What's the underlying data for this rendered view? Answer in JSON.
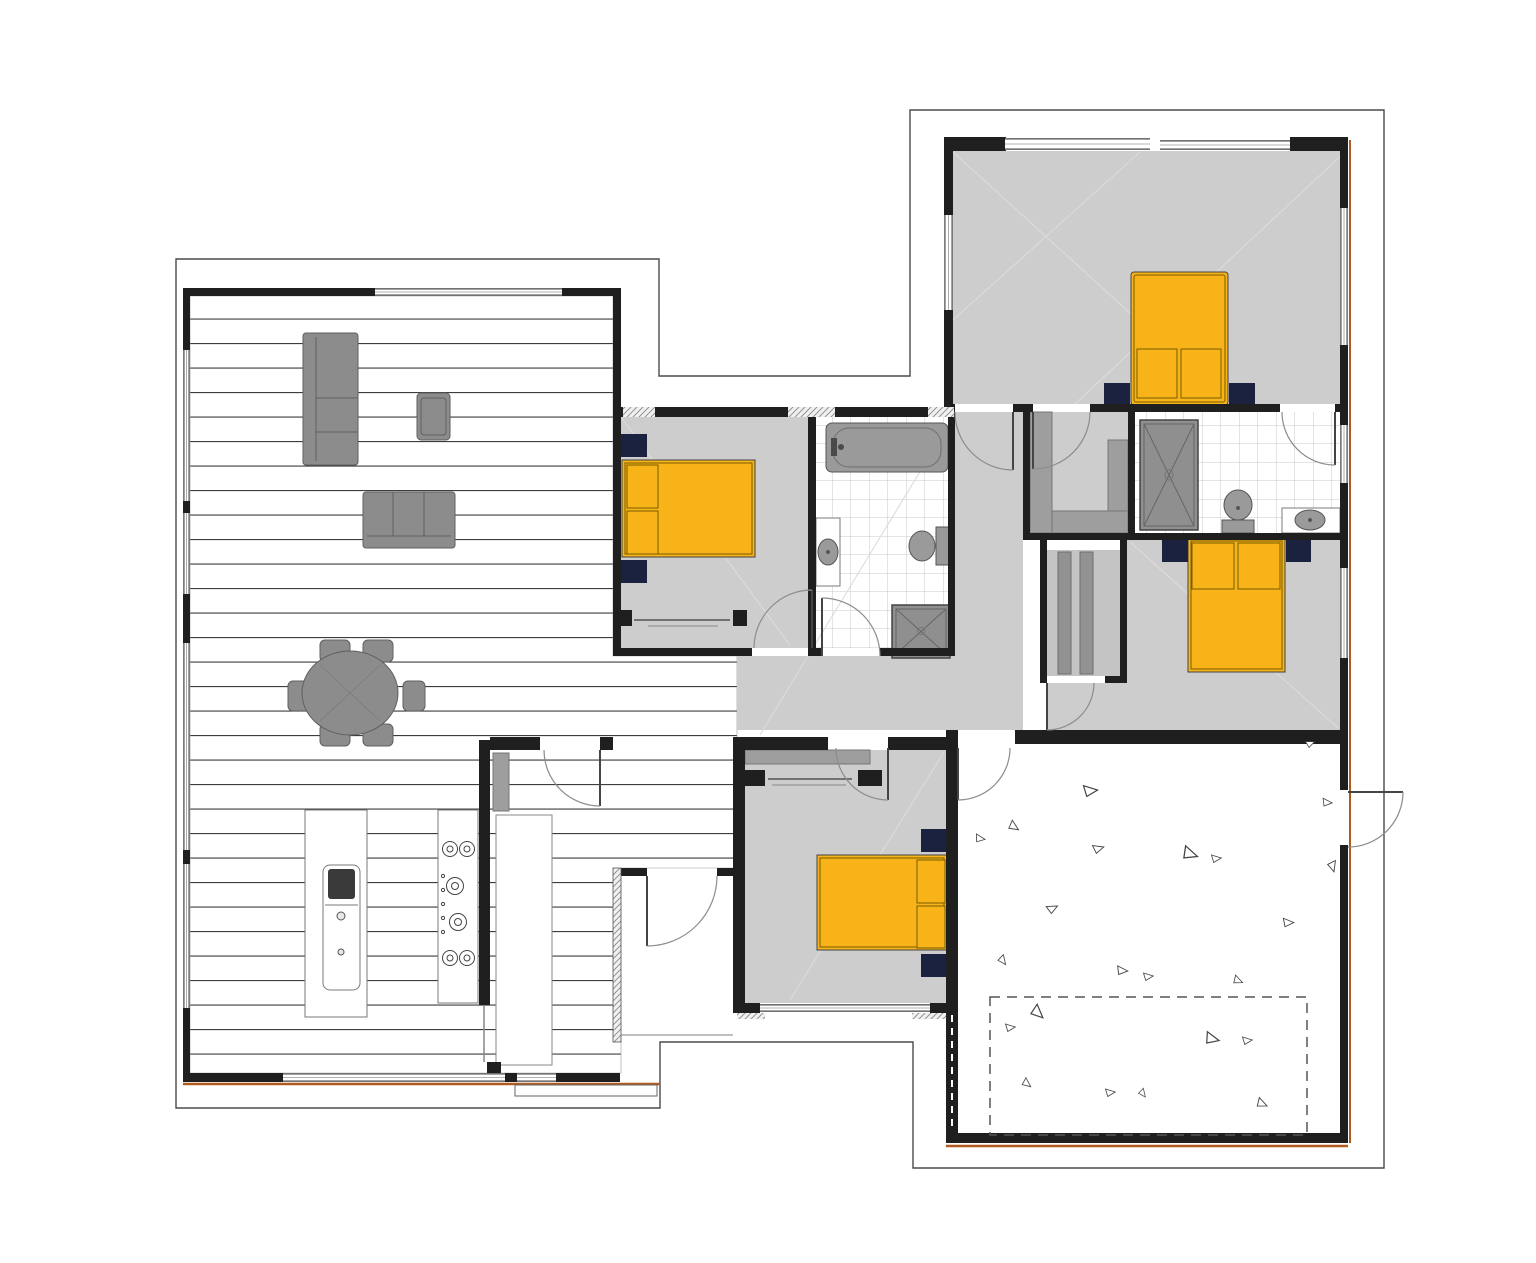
{
  "title": "Single-storey residential floor plan",
  "canvas": {
    "width": 1536,
    "height": 1263
  },
  "colors": {
    "wall": "#1f1f1f",
    "cladding": "#b05a20",
    "boundary": "#4a4a4a",
    "carpet": "#cdcdcd",
    "shelf": "#9e9e9e",
    "furniture": "#8c8c8c",
    "furnitureStroke": "#5f5f5f",
    "counterStroke": "#7a7a7a",
    "bed": "#f7b318",
    "bedStroke": "#7a5c00",
    "nightstand": "#1b2240",
    "fixture": "#9a9a9a",
    "fixtureStroke": "#555555",
    "tileLine": "#c9c9c9",
    "plankLine": "#3d3d3d",
    "hatch": "#8a8a8a",
    "doorArc": "#8c8c8c",
    "doorLeaf": "#444444",
    "faintLine": "#dcdcdc",
    "dash": "#555555",
    "triangle": "#444444"
  },
  "rooms": [
    {
      "id": "living-dining-kitchen",
      "floor": "timber-planks"
    },
    {
      "id": "bedroom-1",
      "floor": "carpet",
      "furniture": [
        "double-bed",
        "nightstand",
        "nightstand",
        "wardrobe"
      ]
    },
    {
      "id": "main-bathroom",
      "floor": "tile",
      "furniture": [
        "bathtub",
        "vanity-sink",
        "toilet",
        "shower"
      ]
    },
    {
      "id": "master-bedroom",
      "floor": "carpet",
      "furniture": [
        "double-bed",
        "nightstand",
        "nightstand"
      ]
    },
    {
      "id": "walk-in-robe",
      "floor": "carpet",
      "furniture": [
        "shelving"
      ]
    },
    {
      "id": "ensuite",
      "floor": "tile",
      "furniture": [
        "shower",
        "toilet",
        "vanity-sink"
      ]
    },
    {
      "id": "bedroom-2",
      "floor": "carpet",
      "furniture": [
        "double-bed",
        "nightstand",
        "nightstand"
      ]
    },
    {
      "id": "bedroom-3",
      "floor": "carpet",
      "furniture": [
        "double-bed",
        "nightstand",
        "nightstand",
        "wardrobe"
      ]
    },
    {
      "id": "hallway",
      "floor": "carpet",
      "furniture": [
        "linen-closet"
      ]
    },
    {
      "id": "laundry-scullery",
      "floor": "timber-planks",
      "furniture": [
        "bench",
        "shelf"
      ]
    },
    {
      "id": "entry-porch",
      "floor": "none"
    },
    {
      "id": "garage",
      "floor": "concrete"
    }
  ],
  "furniture_counts": {
    "beds": 4,
    "sofas": 2,
    "armchairs": 1,
    "dining_chairs": 6,
    "showers": 2,
    "bathtubs": 1,
    "toilets": 2,
    "vanities": 2,
    "kitchen_island": 1,
    "cooktop_burners": 6
  },
  "windows": [
    [
      375,
      288,
      187,
      8
    ],
    [
      283,
      1073,
      222,
      9
    ],
    [
      517,
      1073,
      39,
      9
    ],
    [
      183,
      350,
      7,
      151
    ],
    [
      183,
      513,
      7,
      81
    ],
    [
      183,
      643,
      7,
      207
    ],
    [
      183,
      864,
      7,
      144
    ],
    [
      1005,
      138,
      145,
      12
    ],
    [
      1160,
      140,
      130,
      10
    ],
    [
      944,
      215,
      9,
      95
    ],
    [
      1340,
      208,
      8,
      137
    ],
    [
      1340,
      425,
      8,
      58
    ],
    [
      1340,
      568,
      8,
      90
    ],
    [
      760,
      1004,
      170,
      8
    ]
  ],
  "garage": {
    "dashed_rect": {
      "x": 990,
      "y": 997,
      "w": 317,
      "h": 138
    },
    "triangles": [
      [
        1090,
        790,
        0,
        13
      ],
      [
        1014,
        826,
        40,
        10
      ],
      [
        980,
        838,
        15,
        9
      ],
      [
        1098,
        848,
        -10,
        10
      ],
      [
        1190,
        853,
        25,
        14
      ],
      [
        1216,
        858,
        0,
        9
      ],
      [
        1327,
        802,
        10,
        9
      ],
      [
        1333,
        866,
        80,
        10
      ],
      [
        1052,
        908,
        -20,
        10
      ],
      [
        1288,
        922,
        5,
        10
      ],
      [
        1003,
        960,
        60,
        9
      ],
      [
        1122,
        970,
        10,
        10
      ],
      [
        1148,
        976,
        0,
        9
      ],
      [
        1238,
        980,
        30,
        9
      ],
      [
        1038,
        1012,
        50,
        13
      ],
      [
        1010,
        1027,
        0,
        9
      ],
      [
        1212,
        1038,
        20,
        13
      ],
      [
        1247,
        1040,
        0,
        9
      ],
      [
        1027,
        1083,
        45,
        9
      ],
      [
        1110,
        1092,
        0,
        9
      ],
      [
        1143,
        1093,
        60,
        8
      ],
      [
        1262,
        1103,
        30,
        10
      ],
      [
        1310,
        743,
        -15,
        8
      ]
    ]
  }
}
